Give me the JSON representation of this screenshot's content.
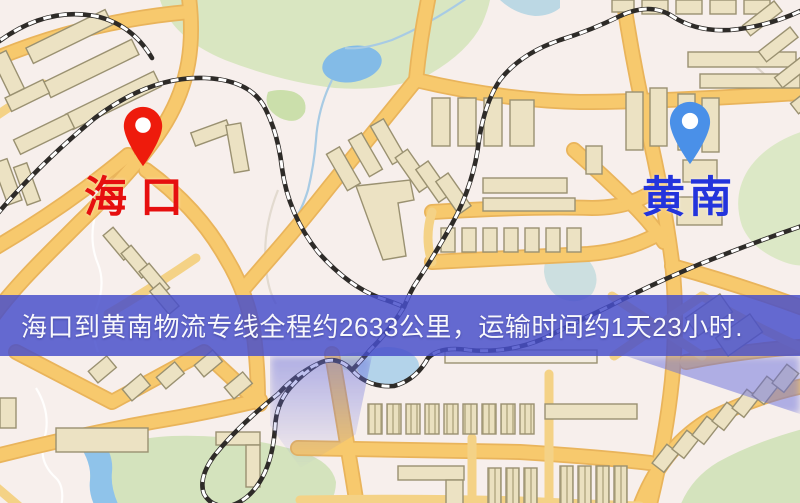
{
  "map": {
    "origin": {
      "name": "海口",
      "label_color": "#e60f0f",
      "pin_color": "#ee1b0c",
      "pin_icon": "red-location-pin"
    },
    "destination": {
      "name": "黄南",
      "label_color": "#2334dc",
      "pin_color": "#4a90e8",
      "pin_icon": "blue-location-pin"
    },
    "banner": {
      "text": "海口到黄南物流专线全程约2633公里，运输时间约1天23小时.",
      "background": "rgba(72,79,202,0.84)",
      "text_color": "#f8f8fc"
    },
    "route": {
      "distance_km": "2633",
      "duration": "1天23小时"
    },
    "palette": {
      "map_background": "#f7efec",
      "road": "#f7c96d",
      "road_casing": "#e9b45b",
      "building": "#ece2c3",
      "park": "#d9e6c1",
      "water": "#83bbe7",
      "railway": "#2e2b28"
    }
  }
}
